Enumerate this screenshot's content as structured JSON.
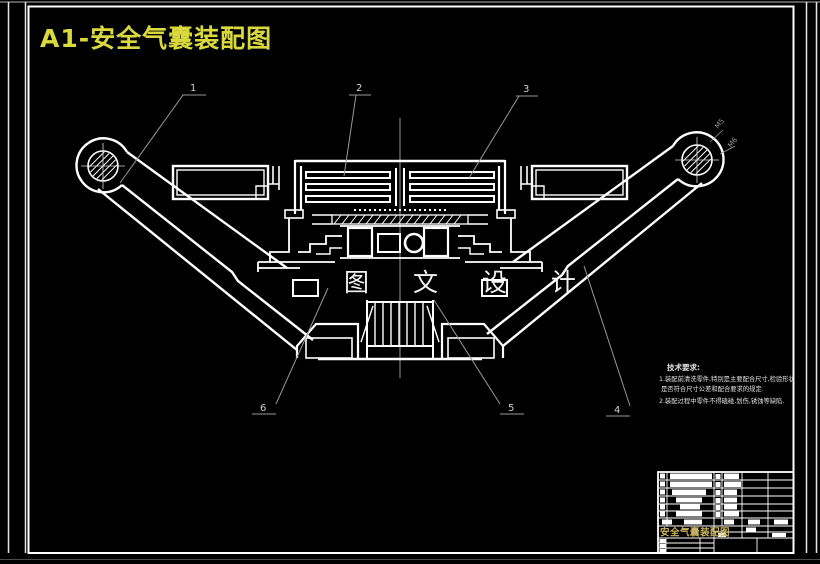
{
  "sheet": {
    "background": "#000000",
    "line_color": "#ffffff",
    "leader_color": "#999999",
    "title": "A1-安全气囊装配图",
    "title_color": "#d9d93e"
  },
  "watermark": {
    "text": "图 文 设 计"
  },
  "part_labels": {
    "p1": "1",
    "p2": "2",
    "p3": "3",
    "p4": "4",
    "p5": "5",
    "p6": "6"
  },
  "thread_annotations": {
    "a1": "M5",
    "a2": "M6"
  },
  "tech_notes": {
    "heading": "技术要求:",
    "line1": "1.装配前清洗零件,特别是主要配合尺寸,检验形状",
    "line2": "是否符合尺寸公差和配合要求的规定.",
    "line3": "2.装配过程中零件不得磕碰,划伤,锈蚀等缺陷."
  },
  "title_block": {
    "drawing_title": "安全气囊装配图",
    "title_color": "#c9b45f"
  }
}
